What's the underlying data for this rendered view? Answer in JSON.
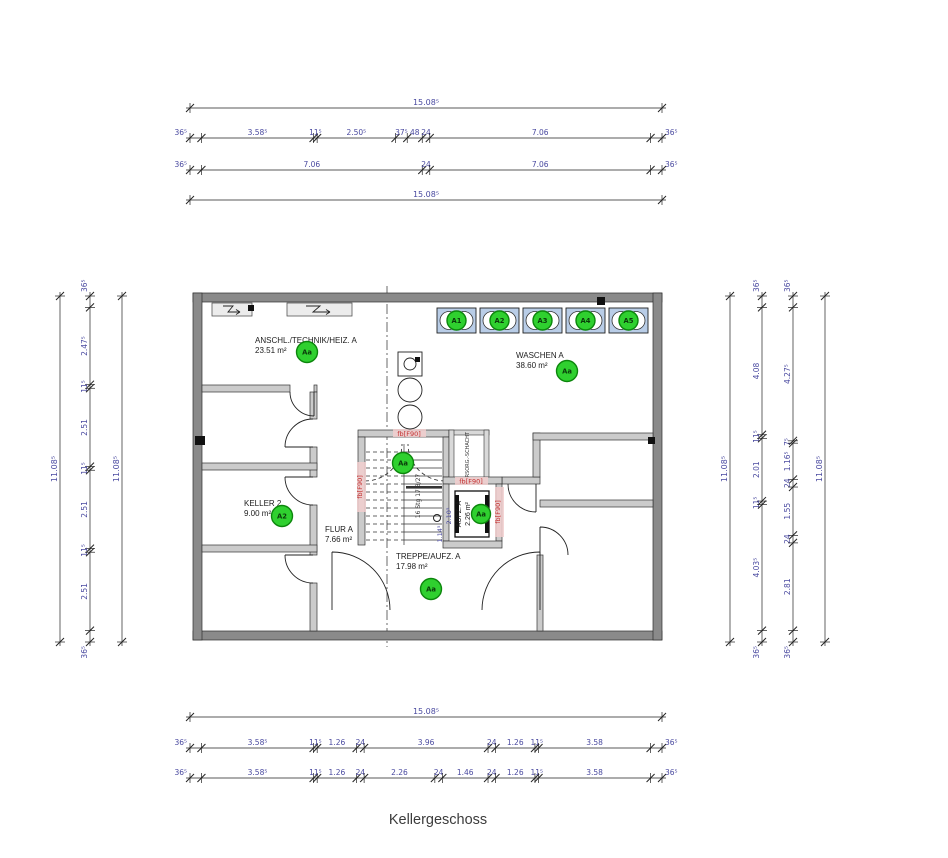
{
  "title": "Kellergeschoss",
  "colors": {
    "dim_text": "#4a4aa0",
    "wall_dark": "#8a8a8a",
    "wall_light": "#cbcbcb",
    "machine_fill": "#b9cde7",
    "marker_green": "#2fd02f",
    "marker_green_border": "#0c860c",
    "fire_red": "#c23030"
  },
  "plan": {
    "fire_rating_label": "fb[F90]",
    "stair_note": "16 Stg 17.8/27",
    "stair_marker": "Aa",
    "shaft_label": "VERSORG.-SCHACHT",
    "elevator_width_label": "1.14⁵",
    "elevator_depth_label": "2.10⁵"
  },
  "rooms": {
    "technik": {
      "name": "ANSCHL./TECHNIK/HEIZ. A",
      "area": "23.51 m²",
      "marker": "Aa"
    },
    "waschen": {
      "name": "WASCHEN A",
      "area": "38.60 m²",
      "marker": "Aa"
    },
    "keller2": {
      "name": "KELLER 2",
      "area": "9.00 m²",
      "marker": "A2"
    },
    "flur": {
      "name": "FLUR A",
      "area": "7.66 m²"
    },
    "treppe": {
      "name": "TREPPE/AUFZ. A",
      "area": "17.98 m²",
      "marker": "Aa"
    },
    "aufzug": {
      "name": "AUFZ. A",
      "area": "2.26 m²",
      "marker": "Aa"
    }
  },
  "machines": [
    "A1",
    "A2",
    "A3",
    "A4",
    "A5"
  ],
  "dimensions": {
    "horizontal": [
      {
        "y": 108,
        "x0": 190,
        "x1": 662,
        "labels": [
          "15.08⁵"
        ]
      },
      {
        "y": 138,
        "x0": 190,
        "x1": 662,
        "labels": [
          "36⁵",
          "3.58⁵",
          "11⁵",
          "2.50⁵",
          "37⁵",
          "48",
          "24",
          "7.06",
          "36⁵"
        ]
      },
      {
        "y": 170,
        "x0": 190,
        "x1": 662,
        "labels": [
          "36⁵",
          "7.06",
          "24",
          "7.06",
          "36⁵"
        ]
      },
      {
        "y": 200,
        "x0": 190,
        "x1": 662,
        "labels": [
          "15.08⁵"
        ]
      },
      {
        "y": 717,
        "x0": 190,
        "x1": 662,
        "labels": [
          "15.08⁵"
        ]
      },
      {
        "y": 748,
        "x0": 190,
        "x1": 662,
        "labels": [
          "36⁵",
          "3.58⁵",
          "11⁵",
          "1.26",
          "24",
          "3.96",
          "24",
          "1.26",
          "11⁵",
          "3.58",
          "36⁵"
        ]
      },
      {
        "y": 778,
        "x0": 190,
        "x1": 662,
        "labels": [
          "36⁵",
          "3.58⁵",
          "11⁵",
          "1.26",
          "24",
          "2.26",
          "24",
          "1.46",
          "24",
          "1.26",
          "11⁵",
          "3.58",
          "36⁵"
        ]
      }
    ],
    "vertical": [
      {
        "x": 60,
        "y0": 296,
        "y1": 642,
        "labels": [
          "11.08⁵"
        ]
      },
      {
        "x": 90,
        "y0": 296,
        "y1": 642,
        "labels": [
          "36⁵",
          "2.47⁵",
          "11⁵",
          "2.51",
          "11⁵",
          "2.51",
          "11⁵",
          "2.51",
          "36⁵"
        ]
      },
      {
        "x": 122,
        "y0": 296,
        "y1": 642,
        "labels": [
          "11.08⁵"
        ]
      },
      {
        "x": 730,
        "y0": 296,
        "y1": 642,
        "labels": [
          "11.08⁵"
        ]
      },
      {
        "x": 762,
        "y0": 296,
        "y1": 642,
        "labels": [
          "36⁵",
          "4.08",
          "11⁵",
          "2.01",
          "11⁵",
          "4.03⁵",
          "36⁵"
        ]
      },
      {
        "x": 793,
        "y0": 296,
        "y1": 642,
        "labels": [
          "36⁵",
          "4.27⁵",
          "7⁵",
          "1.16⁵",
          "24",
          "1.55",
          "24",
          "2.81",
          "36⁵"
        ]
      },
      {
        "x": 825,
        "y0": 296,
        "y1": 642,
        "labels": [
          "11.08⁵"
        ]
      }
    ]
  }
}
